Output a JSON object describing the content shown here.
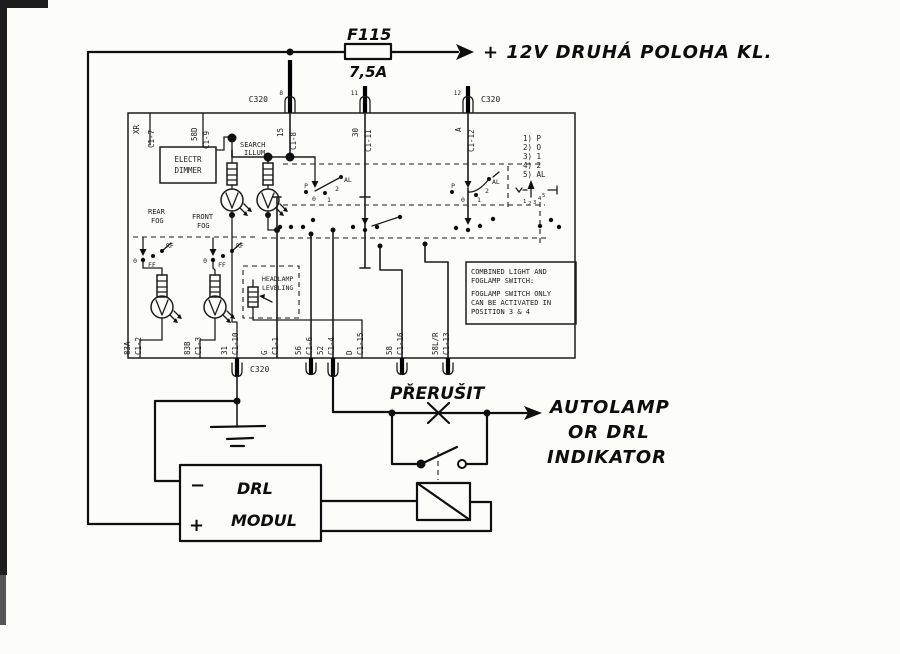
{
  "fuse": {
    "name": "F115",
    "rating": "7,5A"
  },
  "supply_label": "+ 12V DRUHÁ POLOHA KL.",
  "connector_labels": {
    "top_left": "C320",
    "top_right": "C320",
    "bottom": "C320"
  },
  "top_pins": [
    {
      "pin": "8",
      "terminal": "15",
      "circuit": "C1-8"
    },
    {
      "pin": "11",
      "terminal": "30",
      "circuit": "C1-11"
    },
    {
      "pin": "12",
      "terminal": "A",
      "circuit": "C1-12"
    }
  ],
  "left_edge_labels": [
    "XR",
    "C1-7",
    "58D",
    "C1-9"
  ],
  "bottom_terminals": [
    {
      "terminal": "83A",
      "circuit": "C1-2"
    },
    {
      "terminal": "83B",
      "circuit": "C1-3"
    },
    {
      "terminal": "31",
      "circuit": "C1-10"
    },
    {
      "terminal": "G",
      "circuit": "C1-1"
    },
    {
      "terminal": "56",
      "circuit": "C1-6"
    },
    {
      "terminal": "52",
      "circuit": "C1-4"
    },
    {
      "terminal": "D",
      "circuit": "C1-15"
    },
    {
      "terminal": "58",
      "circuit": "C1-16"
    },
    {
      "terminal": "58L/R",
      "circuit": "C1-13"
    }
  ],
  "blocks": {
    "electr_dimmer": [
      "ELECTR",
      "DIMMER"
    ],
    "search_illum": [
      "SEARCH",
      "ILLUM"
    ],
    "rear_fog": [
      "REAR",
      "FOG"
    ],
    "front_fog": [
      "FRONT",
      "FOG"
    ],
    "headlamp_leveling": [
      "HEADLAMP",
      "LEVELING"
    ]
  },
  "switch": {
    "positions_legend": [
      "1)  P",
      "2)  O",
      "3)  1",
      "4)  2",
      "5)  AL"
    ],
    "rotary_positions": [
      "1",
      "2",
      "3",
      "4",
      "5"
    ],
    "main_positions": {
      "p": "P",
      "zero": "0",
      "one": "1",
      "two": "2",
      "al": "AL"
    },
    "fog_positions": {
      "zero": "0",
      "ff": "FF",
      "rf": "RF"
    },
    "note": [
      "COMBINED LIGHT AND",
      "FOGLAMP SWITCH:",
      "FOGLAMP SWITCH ONLY",
      "CAN BE ACTIVATED IN",
      "POSITION 3 & 4"
    ]
  },
  "handwritten": {
    "prerusit": "PŘERUŠIT",
    "indicator": [
      "AUTOLAMP",
      "OR DRL",
      "INDIKATOR"
    ],
    "drl_module": [
      "DRL",
      "MODUL"
    ],
    "minus": "−",
    "plus": "+"
  },
  "colors": {
    "ink": "#1c1c1c",
    "hand_ink": "#0f0f0f",
    "paper": "#fcfcf9"
  }
}
